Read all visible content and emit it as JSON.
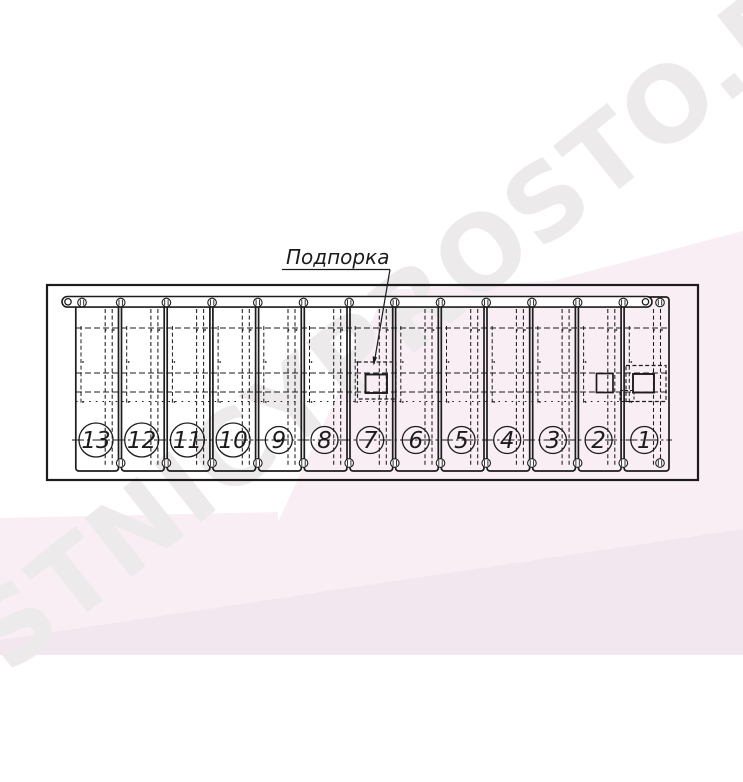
{
  "watermark": {
    "text": "LESTNICYPROSTO.RU",
    "light_pink": "#f8eef4",
    "deep_pink": "#f3e7ef",
    "text_color": "#edeaec"
  },
  "drawing": {
    "label_support": "Подпорка",
    "line_color": "#1c1c1c",
    "steps": [
      {
        "label": "13"
      },
      {
        "label": "12"
      },
      {
        "label": "11"
      },
      {
        "label": "10"
      },
      {
        "label": "9"
      },
      {
        "label": "8"
      },
      {
        "label": "7"
      },
      {
        "label": "6"
      },
      {
        "label": "5"
      },
      {
        "label": "4"
      },
      {
        "label": "3"
      },
      {
        "label": "2"
      },
      {
        "label": "1"
      }
    ]
  }
}
